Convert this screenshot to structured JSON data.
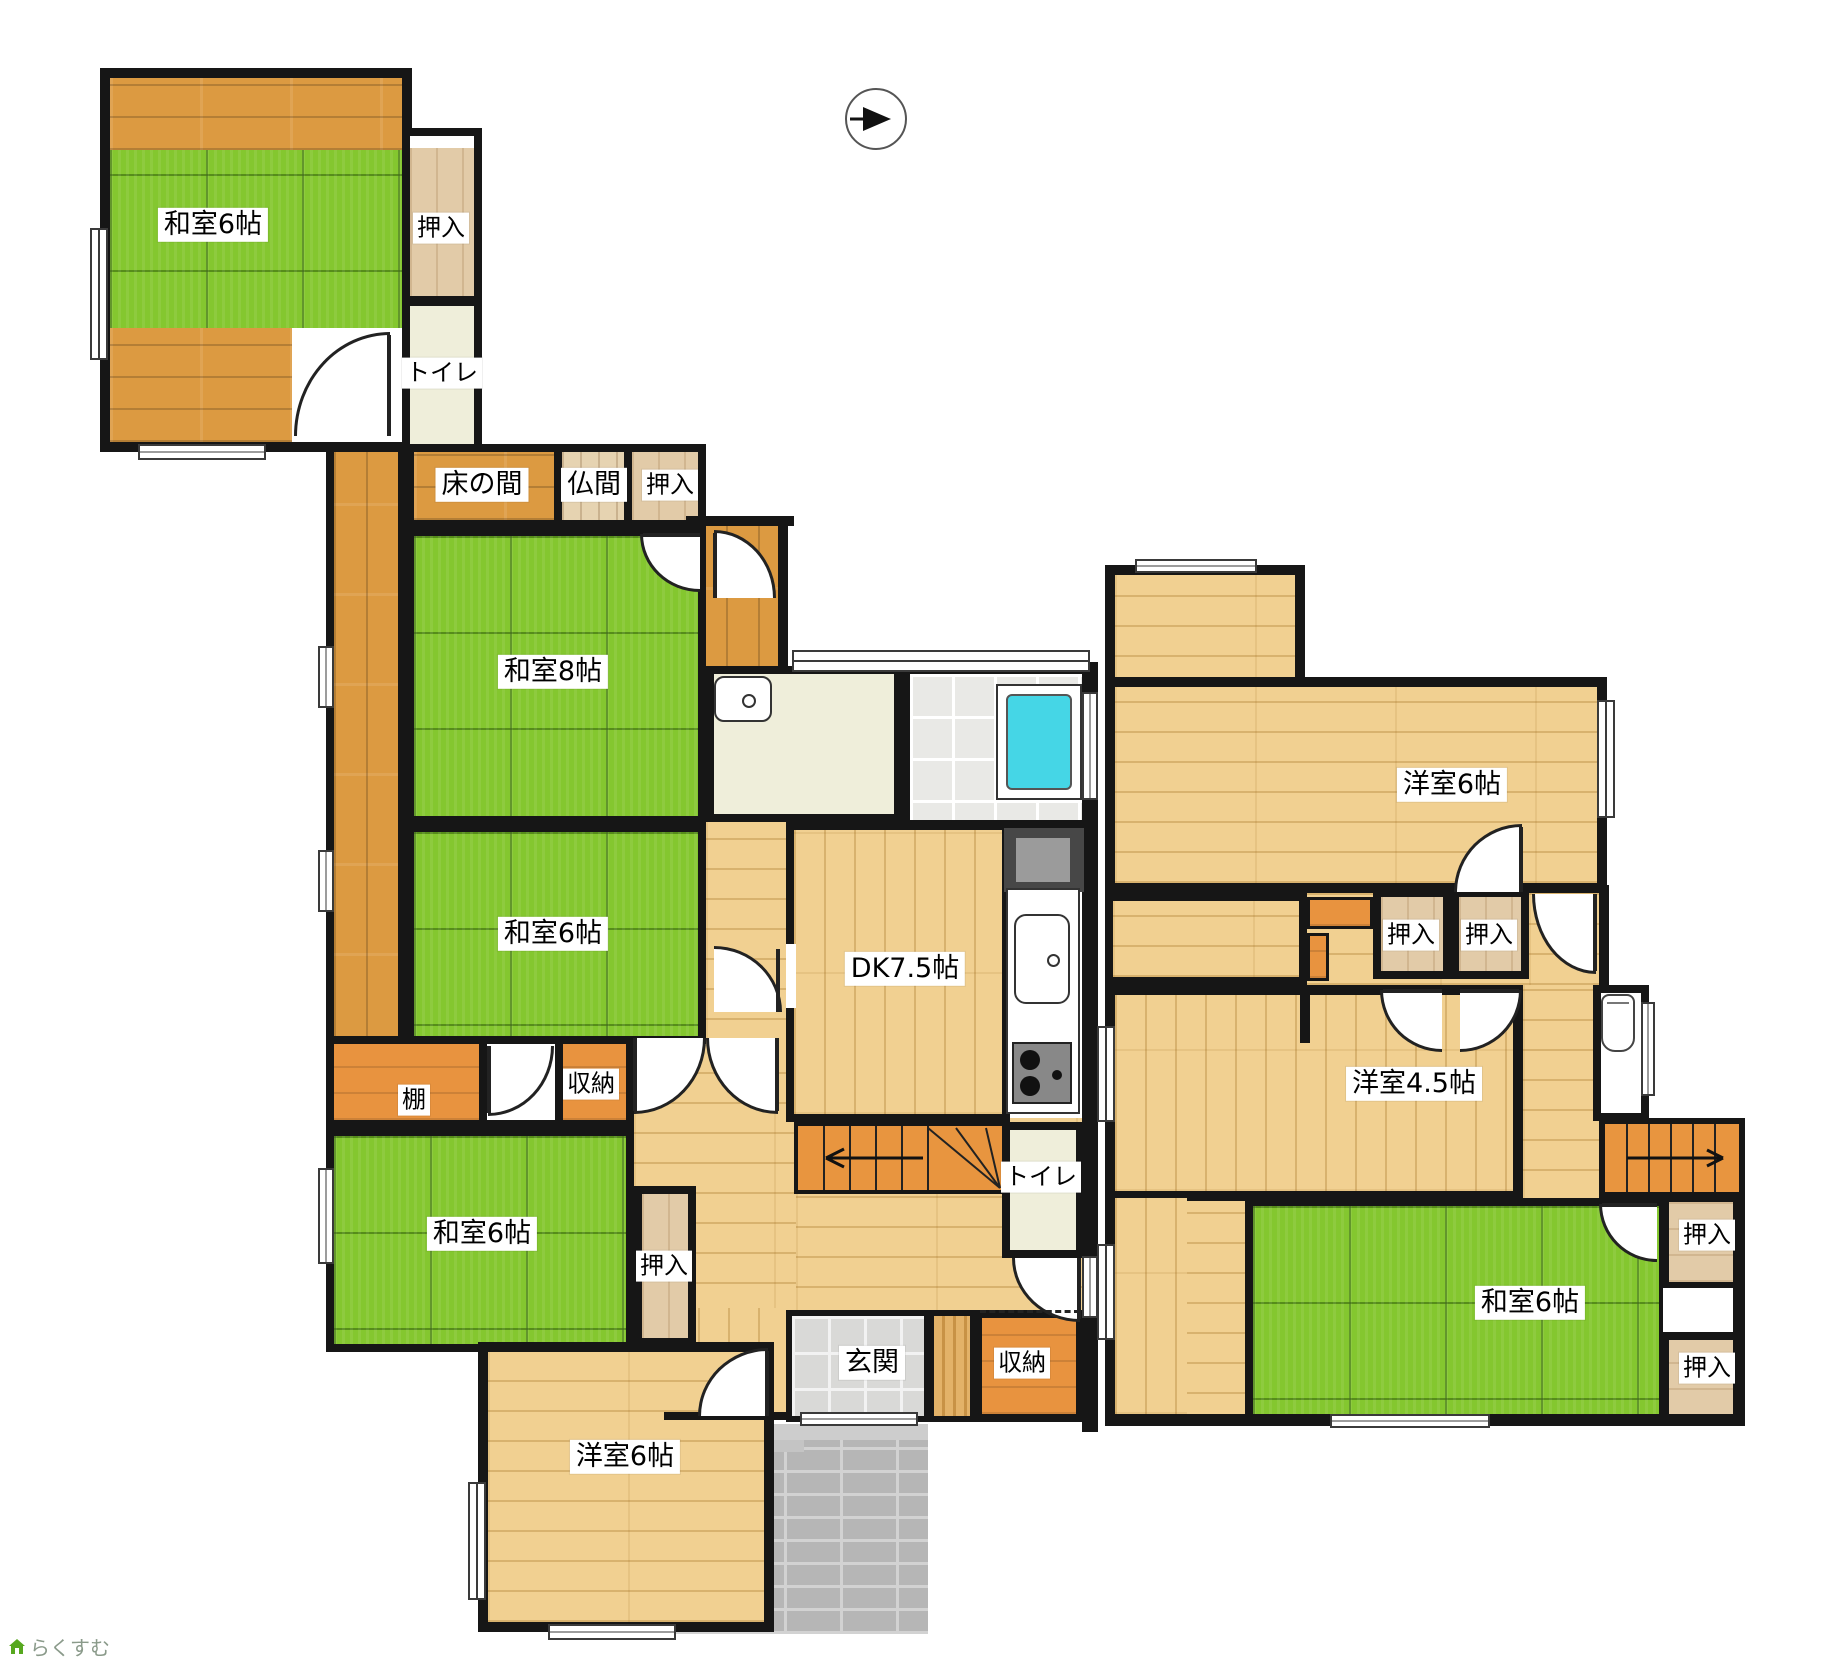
{
  "floor1": {
    "rooms": {
      "washitsu6_tl": "和室6帖",
      "oshiire_tl": "押入",
      "toilet_tl": "トイレ",
      "tokonoma": "床の間",
      "butsuma": "仏間",
      "oshiire_8": "押入",
      "washitsu8": "和室8帖",
      "washitsu6_mid": "和室6帖",
      "tana": "棚",
      "shuunou_mid": "収納",
      "washitsu6_bl": "和室6帖",
      "oshiire_bl": "押入",
      "dk": "DK7.5帖",
      "toilet_1f": "トイレ",
      "genkan": "玄関",
      "shuunou_genkan": "収納",
      "youshitsu6_1f": "洋室6帖"
    }
  },
  "floor2": {
    "rooms": {
      "youshitsu6_2f": "洋室6帖",
      "oshiire_2f_a": "押入",
      "oshiire_2f_b": "押入",
      "youshitsu45": "洋室4.5帖",
      "washitsu6_2f": "和室6帖",
      "oshiire_2f_c": "押入",
      "oshiire_2f_d": "押入"
    }
  },
  "logo": {
    "text": "らくすむ"
  },
  "colors": {
    "tatami_green": "#84c72f",
    "wood_orange": "#dc9a41",
    "wood_light": "#f1d091",
    "closet_tan": "#e2cba8",
    "floor_cream": "#efeeda",
    "bath_tile": "#e9e9e6",
    "genkan_tile": "#d9d9d7",
    "approach_gray": "#b6b6b6",
    "bathtub_cyan": "#45d6e6",
    "wall_black": "#161616",
    "logo_green": "#57a81f"
  }
}
